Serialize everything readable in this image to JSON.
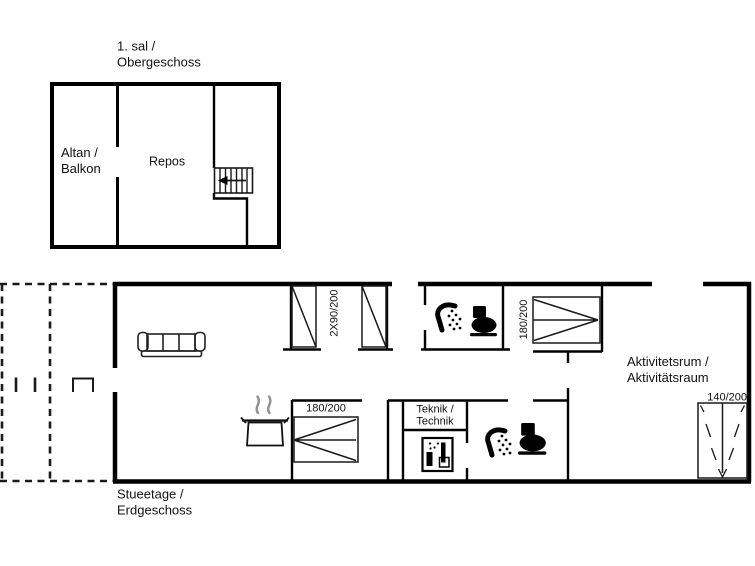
{
  "floor_plan": {
    "upper_floor": {
      "title_line1": "1. sal /",
      "title_line2": "Obergeschoss",
      "balcony_line1": "Altan /",
      "balcony_line2": "Balkon",
      "landing": "Repos"
    },
    "ground_floor": {
      "title_line1": "Stueetage /",
      "title_line2": "Erdgeschoss",
      "activity_room_line1": "Aktivitetsrum /",
      "activity_room_line2": "Aktivitätsraum",
      "technic_room_line1": "Teknik /",
      "technic_room_line2": "Technik",
      "bed_label_twin": "2X90/200",
      "bed_label_double_1": "180/200",
      "bed_label_double_2": "180/200",
      "door_label": "140/200"
    },
    "icons": {
      "staircase": "staircase-icon",
      "stair_arrow": "stair-direction-arrow-icon",
      "sofa": "sofa-icon",
      "cooking_pot": "cooking-pot-icon",
      "shower": "shower-icon",
      "toilet": "toilet-icon",
      "washing_machine": "washing-machine-icon",
      "single_bed": "single-bed-icon",
      "double_bed": "double-bed-icon",
      "double_door": "double-door-icon",
      "terrace": "terrace-dashed-outline"
    },
    "colors": {
      "line": "#000000",
      "background": "#ffffff",
      "steam": "#8f8f8f"
    }
  }
}
